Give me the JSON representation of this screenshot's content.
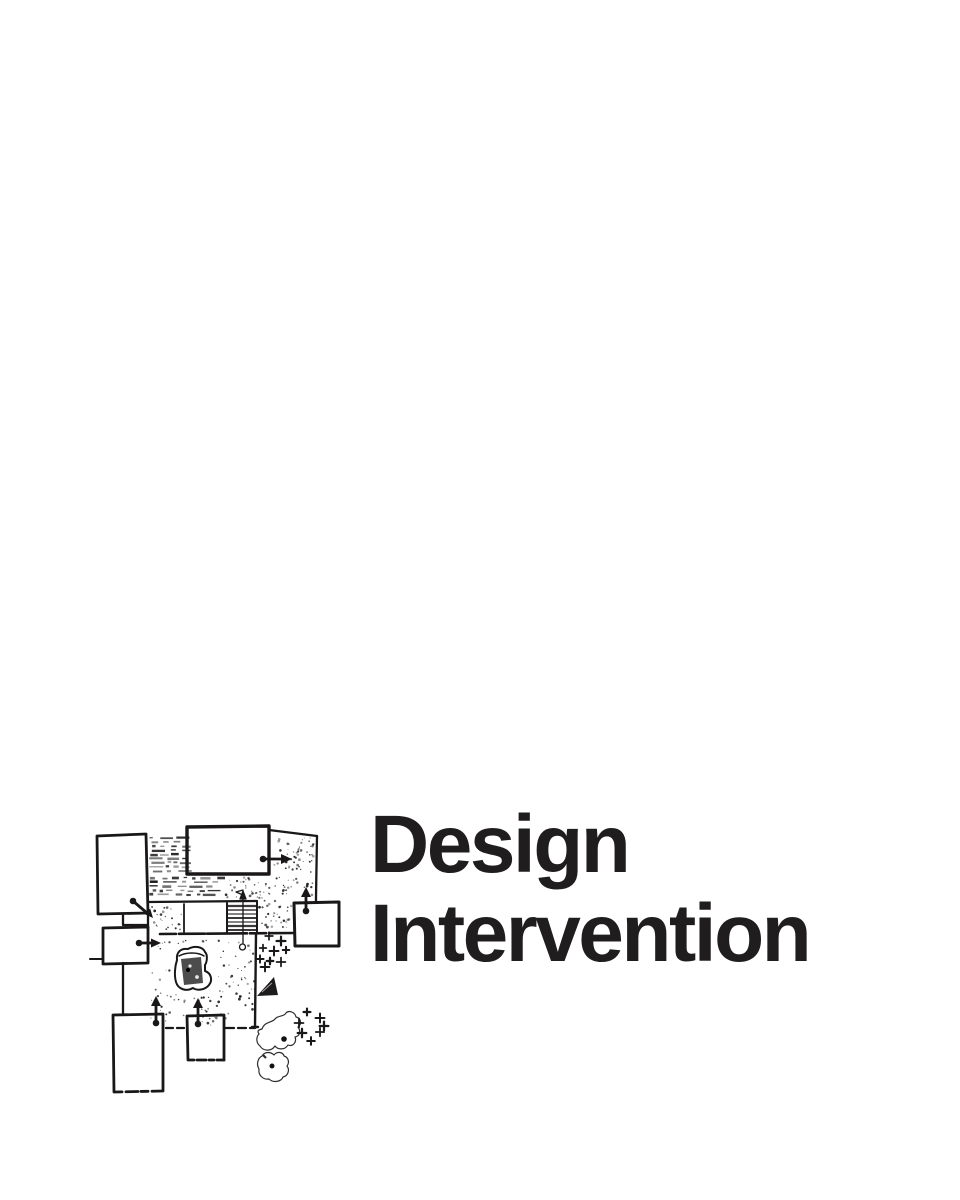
{
  "page": {
    "background": "#ffffff"
  },
  "title": {
    "line1": "Design",
    "line2": "Intervention",
    "color": "#201d1e"
  },
  "illustration": {
    "name": "site-plan-sketch",
    "description": "Hand-drawn architectural site plan sketch with rooms, circulation arrows, stair, furniture, trees and planting marks",
    "ink_color": "#191717"
  }
}
